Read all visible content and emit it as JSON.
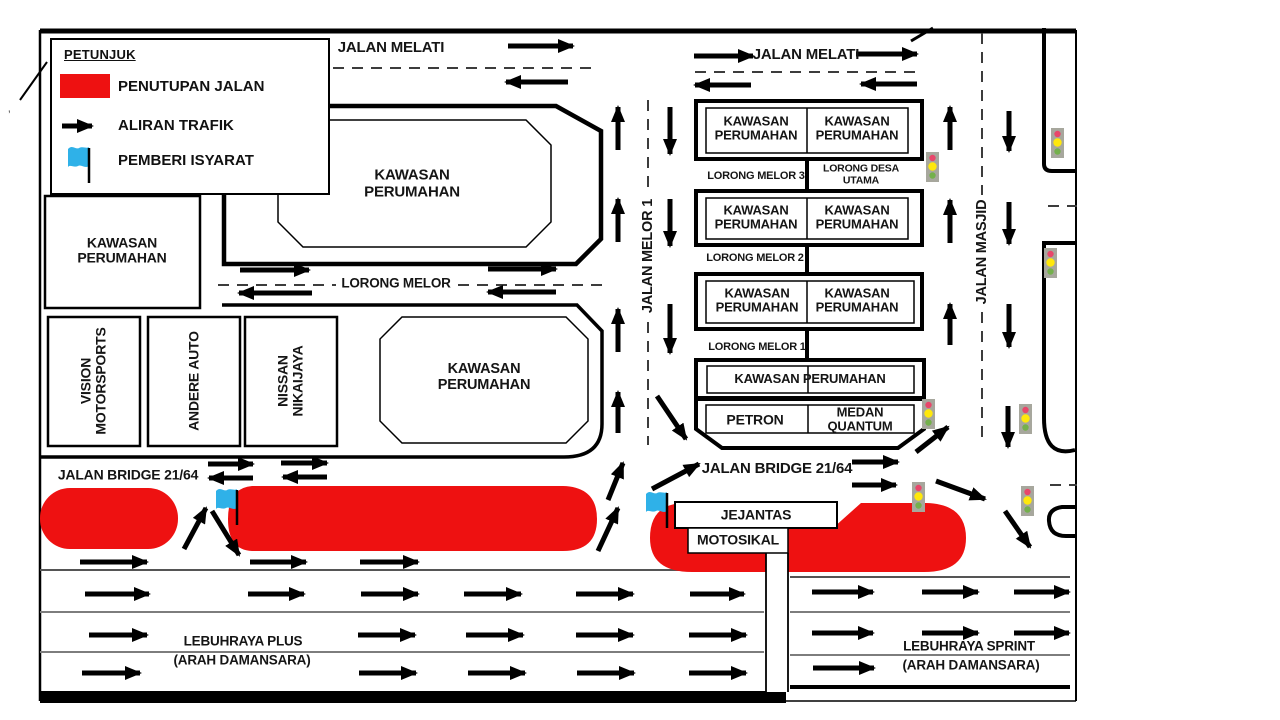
{
  "legend": {
    "title": "PETUNJUK",
    "items": [
      {
        "icon": "road-closure-swatch",
        "label": "PENUTUPAN JALAN"
      },
      {
        "icon": "traffic-flow-arrow",
        "label": "ALIRAN TRAFIK"
      },
      {
        "icon": "signal-flag",
        "label": "PEMBERI ISYARAT"
      }
    ]
  },
  "roads": {
    "jalan_melati": "JALAN MELATI",
    "lorong_melor": "LORONG MELOR",
    "jalan_melor_1": "JALAN MELOR 1",
    "lorong_melor_3": "LORONG MELOR 3",
    "lorong_desa_utama": "LORONG DESA UTAMA",
    "lorong_melor_2": "LORONG MELOR 2",
    "lorong_melor_1": "LORONG MELOR 1",
    "jalan_masjid": "JALAN MASJID",
    "jalan_bridge": "JALAN BRIDGE 21/64",
    "jejantas": "JEJANTAS",
    "motosikal": "MOTOSIKAL",
    "lebuhraya_plus": "LEBUHRAYA PLUS",
    "lebuhraya_sprint": "LEBUHRAYA SPRINT",
    "arah_damansara": "(ARAH DAMANSARA)"
  },
  "buildings": {
    "kawasan_perumahan": "KAWASAN PERUMAHAN",
    "vision": "VISION MOTORSPORTS",
    "andere": "ANDERE AUTO",
    "nissan": "NISSAN NIKAIJAYA",
    "petron": "PETRON",
    "medan_quantum": "MEDAN QUANTUM"
  },
  "misc": {
    "stray_mark": "’"
  },
  "colors": {
    "closure": "#ee1111",
    "flag": "#2fb1e8",
    "signal_body": "#a7a79d",
    "signal_red": "#e8476b",
    "signal_yellow": "#ffe80c",
    "signal_green": "#74b04c",
    "lane_line": "#7d7d7d"
  },
  "flow_arrows": [
    [
      508,
      46,
      573,
      46
    ],
    [
      568,
      82,
      506,
      82
    ],
    [
      694,
      56,
      753,
      56
    ],
    [
      856,
      54,
      917,
      54
    ],
    [
      751,
      85,
      695,
      85
    ],
    [
      917,
      84,
      861,
      84
    ],
    [
      240,
      270,
      309,
      270
    ],
    [
      488,
      269,
      556,
      269
    ],
    [
      312,
      293,
      239,
      293
    ],
    [
      556,
      292,
      488,
      292
    ],
    [
      618,
      150,
      618,
      107
    ],
    [
      618,
      242,
      618,
      199
    ],
    [
      618,
      352,
      618,
      309
    ],
    [
      618,
      433,
      618,
      392
    ],
    [
      670,
      107,
      670,
      154
    ],
    [
      670,
      199,
      670,
      246
    ],
    [
      670,
      304,
      670,
      353
    ],
    [
      657,
      396,
      686,
      439
    ],
    [
      950,
      150,
      950,
      107
    ],
    [
      950,
      243,
      950,
      200
    ],
    [
      950,
      345,
      950,
      304
    ],
    [
      1009,
      111,
      1009,
      151
    ],
    [
      1009,
      202,
      1009,
      244
    ],
    [
      1009,
      304,
      1009,
      347
    ],
    [
      1008,
      406,
      1008,
      447
    ],
    [
      208,
      464,
      253,
      464
    ],
    [
      253,
      478,
      209,
      478
    ],
    [
      281,
      463,
      327,
      463
    ],
    [
      327,
      477,
      283,
      477
    ],
    [
      184,
      549,
      206,
      508
    ],
    [
      212,
      511,
      239,
      555
    ],
    [
      598,
      551,
      618,
      508
    ],
    [
      608,
      500,
      623,
      463
    ],
    [
      652,
      489,
      699,
      464
    ],
    [
      852,
      462,
      898,
      462
    ],
    [
      852,
      485,
      896,
      485
    ],
    [
      916,
      452,
      948,
      427
    ],
    [
      936,
      481,
      985,
      499
    ],
    [
      1005,
      511,
      1030,
      547
    ],
    [
      80,
      562,
      147,
      562
    ],
    [
      250,
      562,
      306,
      562
    ],
    [
      360,
      562,
      418,
      562
    ],
    [
      85,
      594,
      149,
      594
    ],
    [
      248,
      594,
      304,
      594
    ],
    [
      361,
      594,
      418,
      594
    ],
    [
      464,
      594,
      521,
      594
    ],
    [
      576,
      594,
      633,
      594
    ],
    [
      690,
      594,
      744,
      594
    ],
    [
      89,
      635,
      147,
      635
    ],
    [
      358,
      635,
      415,
      635
    ],
    [
      466,
      635,
      523,
      635
    ],
    [
      576,
      635,
      633,
      635
    ],
    [
      689,
      635,
      746,
      635
    ],
    [
      82,
      673,
      140,
      673
    ],
    [
      359,
      673,
      416,
      673
    ],
    [
      468,
      673,
      525,
      673
    ],
    [
      577,
      673,
      634,
      673
    ],
    [
      689,
      673,
      746,
      673
    ],
    [
      812,
      592,
      873,
      592
    ],
    [
      922,
      592,
      978,
      592
    ],
    [
      1014,
      592,
      1069,
      592
    ],
    [
      812,
      633,
      873,
      633
    ],
    [
      922,
      633,
      978,
      633
    ],
    [
      1014,
      633,
      1069,
      633
    ],
    [
      813,
      668,
      874,
      668
    ]
  ],
  "traffic_lights": [
    [
      926,
      152
    ],
    [
      1051,
      128
    ],
    [
      1044,
      248
    ],
    [
      922,
      399
    ],
    [
      1019,
      404
    ],
    [
      912,
      482
    ],
    [
      1021,
      486
    ]
  ],
  "flaggers": [
    [
      216,
      487
    ],
    [
      646,
      490
    ]
  ]
}
